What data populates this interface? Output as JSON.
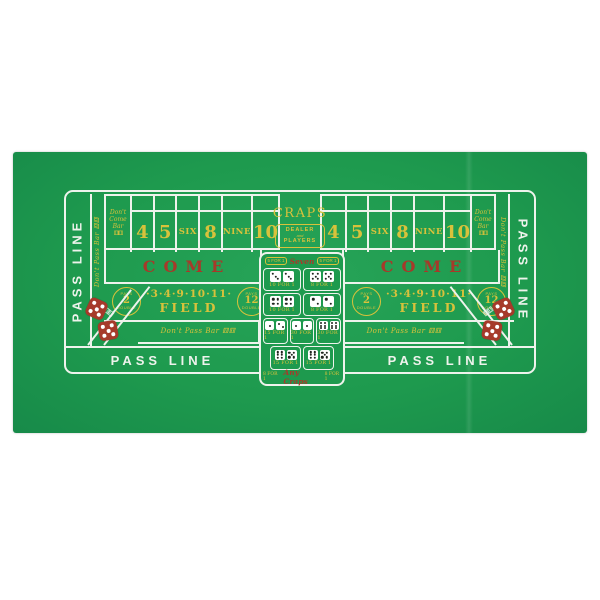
{
  "colors": {
    "felt": "#1e9a4e",
    "line": "#eef3ec",
    "gold": "#d8c23b",
    "red": "#a63a2a"
  },
  "layout": {
    "pass_line": "PASS LINE",
    "dont_pass_bar": "Don't Pass Bar",
    "bar_dice": "⚅⚅",
    "come": "COME",
    "craps": "CRAPS",
    "dealer": "DEALER",
    "and": "and",
    "players": "PLAYERS",
    "dont_come": {
      "l1": "Don't",
      "l2": "Come",
      "l3": "Bar"
    },
    "numbers": [
      "4",
      "5",
      "SIX",
      "8",
      "NINE",
      "10"
    ],
    "field": {
      "pays": "PAYS",
      "double": "DOUBLE",
      "two": "2",
      "twelve": "12",
      "numbers": "·3·4·9·10·11·",
      "label": "FIELD"
    }
  },
  "props": {
    "seven": {
      "left": "5 FOR 1",
      "label": "Seven",
      "right": "5 FOR 1"
    },
    "hardways": [
      {
        "dice": "3,3",
        "pay": "10 FOR 1"
      },
      {
        "dice": "5,5",
        "pay": "8 FOR 1"
      },
      {
        "dice": "4,4",
        "pay": "10 FOR 1"
      },
      {
        "dice": "2,2",
        "pay": "8 FOR 1"
      }
    ],
    "craps_row": [
      {
        "dice": "1,2",
        "pay": "15 FOR 1"
      },
      {
        "dice": "1,1",
        "pay": "30 FOR 1"
      },
      {
        "dice": "6,6",
        "pay": "30 FOR 1"
      }
    ],
    "eleven_row": [
      {
        "dice": "6,5",
        "pay": "15 FOR 1"
      },
      {
        "dice": "6,5",
        "pay": "15 FOR 1"
      }
    ],
    "any_craps": {
      "left": "8 FOR 1",
      "label": "Any Craps",
      "right": "8 FOR 1"
    }
  },
  "decor": {
    "corner_dice": [
      "5",
      "5"
    ],
    "bar_corner_dice": "6,6"
  }
}
